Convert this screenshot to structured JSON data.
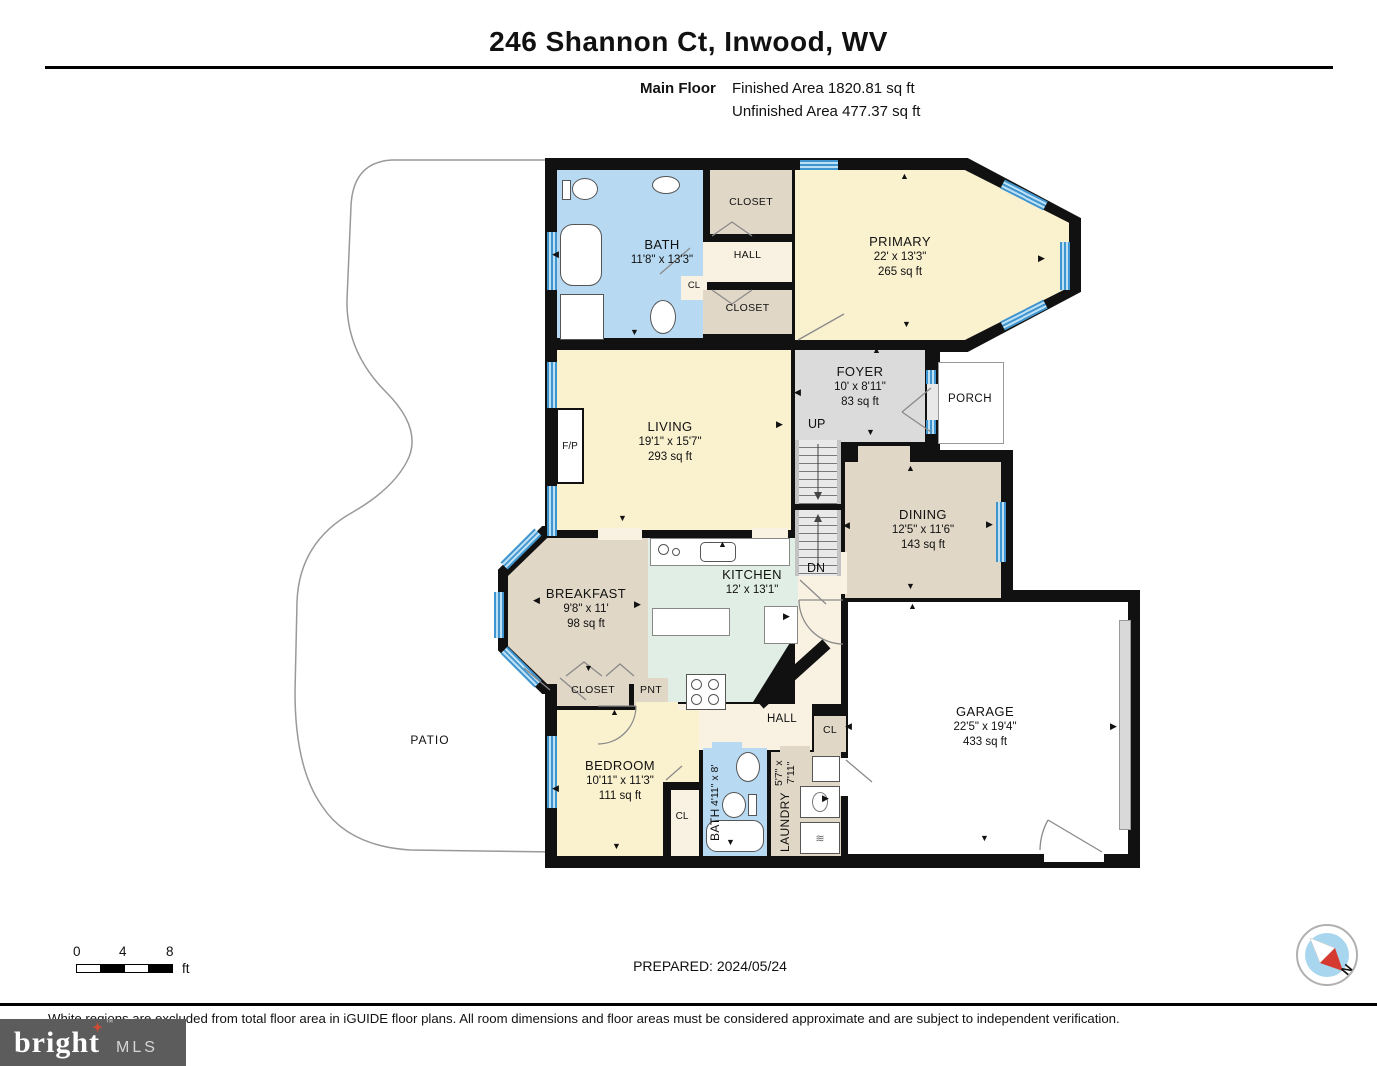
{
  "header": {
    "title": "246 Shannon Ct, Inwood, WV",
    "floor_label": "Main Floor",
    "finished_area": "Finished Area 1820.81 sq ft",
    "unfinished_area": "Unfinished Area 477.37 sq ft"
  },
  "rooms": {
    "bath_top": {
      "name": "BATH",
      "dims": "11'8\" x 13'3\""
    },
    "closet_top": {
      "name": "CLOSET"
    },
    "hall_top": {
      "name": "HALL"
    },
    "cl_top": {
      "name": "CL"
    },
    "closet_mid": {
      "name": "CLOSET"
    },
    "primary": {
      "name": "PRIMARY",
      "dims": "22' x 13'3\"",
      "area": "265 sq ft"
    },
    "living": {
      "name": "LIVING",
      "dims": "19'1\" x 15'7\"",
      "area": "293 sq ft"
    },
    "foyer": {
      "name": "FOYER",
      "dims": "10' x 8'11\"",
      "area": "83 sq ft"
    },
    "porch": {
      "name": "PORCH"
    },
    "dining": {
      "name": "DINING",
      "dims": "12'5\" x 11'6\"",
      "area": "143 sq ft"
    },
    "breakfast": {
      "name": "BREAKFAST",
      "dims": "9'8\" x 11'",
      "area": "98 sq ft"
    },
    "kitchen": {
      "name": "KITCHEN",
      "dims": "12' x 13'1\""
    },
    "closet_bottom": {
      "name": "CLOSET"
    },
    "pantry": {
      "name": "PNT"
    },
    "hall_bottom": {
      "name": "HALL"
    },
    "cl_hall": {
      "name": "CL"
    },
    "bedroom": {
      "name": "BEDROOM",
      "dims": "10'11\" x 11'3\"",
      "area": "111 sq ft"
    },
    "cl_bedroom": {
      "name": "CL"
    },
    "bath_bottom": {
      "name": "BATH",
      "dims": "4'11\" x 8'"
    },
    "laundry": {
      "name": "LAUNDRY",
      "dims": "5'7\" x 7'11\""
    },
    "garage": {
      "name": "GARAGE",
      "dims": "22'5\" x 19'4\"",
      "area": "433 sq ft"
    },
    "patio": {
      "name": "PATIO"
    }
  },
  "annotations": {
    "up": "UP",
    "dn": "DN",
    "fireplace": "F/P"
  },
  "glyphs": {
    "up": "▲",
    "down": "▼",
    "left": "◀",
    "right": "▶",
    "dryer": "≋"
  },
  "scale_bar": {
    "tick0": "0",
    "tick4": "4",
    "tick8": "8",
    "unit": "ft"
  },
  "footer": {
    "prepared": "PREPARED: 2024/05/24",
    "disclaimer": "White regions are excluded from total floor area in iGUIDE floor plans. All room dimensions and floor areas must be considered approximate and are subject to independent verification."
  },
  "compass": {
    "label": "N"
  },
  "logo": {
    "brand": "bright",
    "suffix": "MLS",
    "tm": "™"
  },
  "colors": {
    "room_yellow": "#faf1cf",
    "room_blue": "#b7d9f1",
    "room_tan": "#e1d7c7",
    "room_gray": "#dbdbdb",
    "room_mint": "#e1eee6",
    "room_cream": "#f9f2e2",
    "window_blue": "#4aa2d9",
    "wall": "#111111"
  }
}
